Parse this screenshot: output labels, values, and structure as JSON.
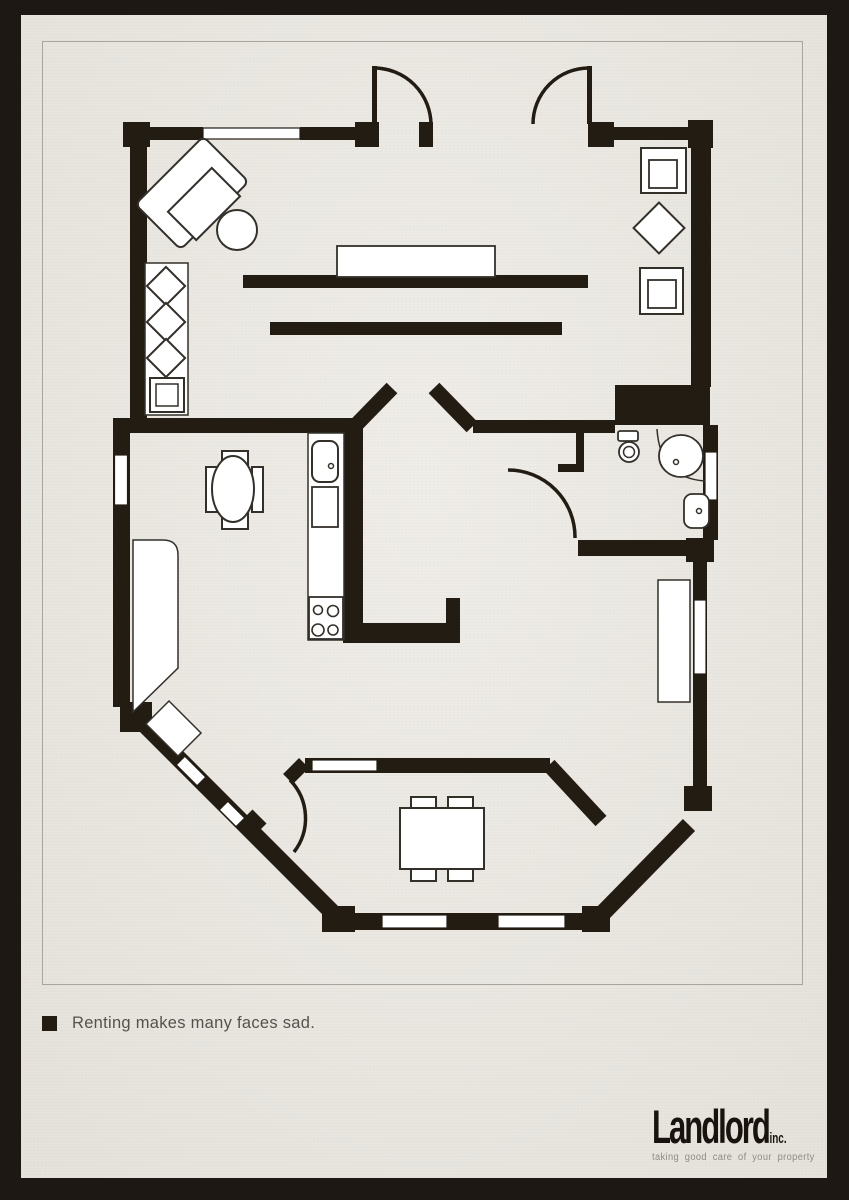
{
  "poster": {
    "footnote": {
      "bullet": "",
      "text": "Renting makes many faces sad."
    },
    "logo": {
      "name": "Landlord",
      "suffix": "inc.",
      "tagline": "taking good care of your property"
    },
    "colors": {
      "paper": "#ebe8e2",
      "frame": "#1d1813",
      "wall": "#231c13",
      "furniture_outline": "#33302a",
      "window_fill": "#ffffff",
      "text": "#55524d",
      "logo_text": "#18130e",
      "logo_tagline": "#8f8b85",
      "hairline": "#a9a59d"
    }
  }
}
